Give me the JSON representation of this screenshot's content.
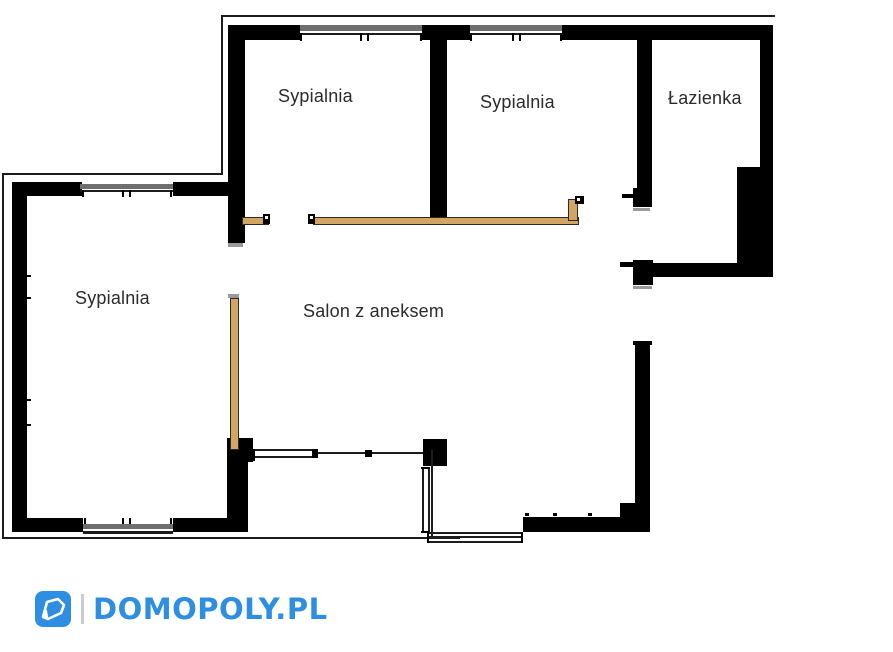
{
  "floor_plan": {
    "rooms": [
      {
        "id": "bedroom-top-left",
        "label": "Sypialnia"
      },
      {
        "id": "bedroom-top-middle",
        "label": "Sypialnia"
      },
      {
        "id": "bathroom",
        "label": "Łazienka"
      },
      {
        "id": "bedroom-left",
        "label": "Sypialnia"
      },
      {
        "id": "living-room",
        "label": "Salon z aneksem"
      }
    ],
    "colors": {
      "wall": "#000000",
      "door_panel": "#d2a562",
      "window_glass": "#6e6e6e",
      "label_text": "#2b2b2b",
      "background": "#ffffff"
    }
  },
  "footer": {
    "brand_text": "DOMOPOLY.PL",
    "brand_color": "#2e8fe2",
    "logo_icon": "domopoly-house-icon",
    "separator_color": "#c8cdd2"
  }
}
